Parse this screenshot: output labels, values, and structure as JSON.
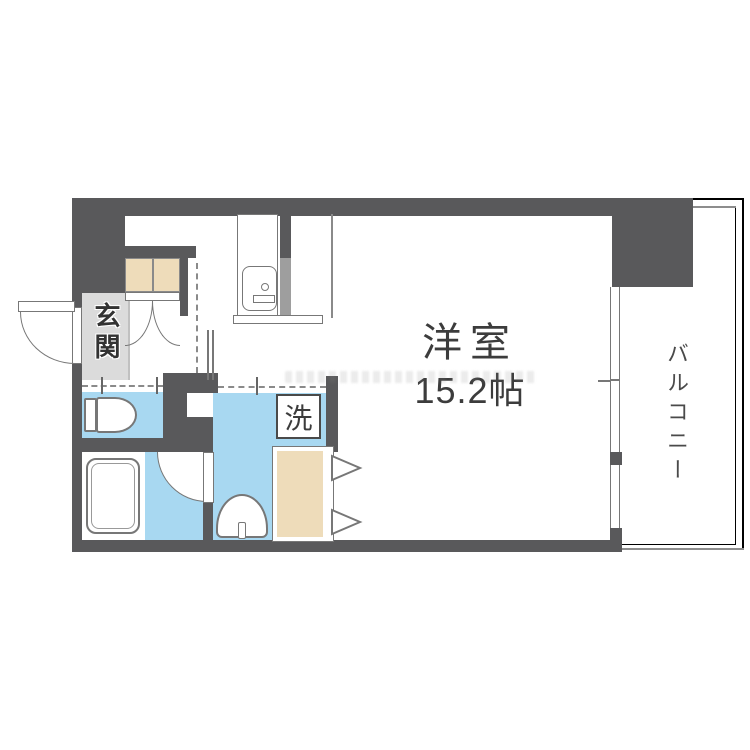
{
  "floorplan": {
    "labels": {
      "main_room": "洋室",
      "main_room_size": "15.2帖",
      "entrance": "玄関",
      "balcony": "バルコニー",
      "washing_machine": "洗"
    },
    "colors": {
      "wall": "#59595b",
      "wet_area_floor": "#a8d8f1",
      "wood_storage": "#eedcba",
      "entrance_floor": "#dbdbdb",
      "pipe_space": "#9e9e9e",
      "outline": "#777777",
      "label_text": "#3c3c3c"
    },
    "fixtures": [
      "entrance-door",
      "closet-double-door",
      "kitchen-sink-unit",
      "kitchen-counter",
      "toilet",
      "bathtub",
      "bathroom-door",
      "washbasin",
      "washing-machine-pan",
      "storage-bifold-door",
      "balcony-window"
    ]
  }
}
